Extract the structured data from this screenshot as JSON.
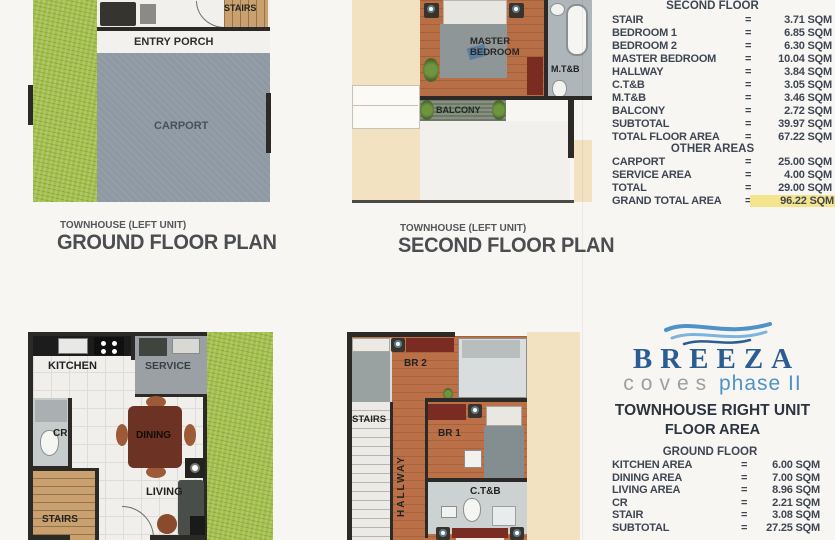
{
  "colors": {
    "grass": "#a4c04d",
    "carport_gray": "#8e99a4",
    "wood_floor": "#b96f45",
    "stair_wood": "#c9a06e",
    "beige": "#f3e2c2",
    "wall_black": "#2b2a27",
    "table_text": "#3f4653",
    "highlight_yellow": "#f5e48e",
    "logo_dark_blue": "#2b5d92",
    "logo_light_blue": "#4e92c8",
    "logo_gray": "#9aa0a5",
    "dark_red_furniture": "#7a2b22"
  },
  "plan_ground_left": {
    "caption_small": "TOWNHOUSE (LEFT UNIT)",
    "caption_large": "GROUND FLOOR PLAN",
    "labels": {
      "stairs": "STAIRS",
      "entry_porch": "ENTRY PORCH",
      "carport": "CARPORT"
    }
  },
  "plan_second_left": {
    "caption_small": "TOWNHOUSE (LEFT UNIT)",
    "caption_large": "SECOND FLOOR PLAN",
    "labels": {
      "master_bedroom": "MASTER BEDROOM",
      "mtb": "M.T&B",
      "balcony": "BALCONY"
    }
  },
  "plan_ground_right_unit": {
    "labels": {
      "kitchen": "KITCHEN",
      "service": "SERVICE",
      "cr": "CR",
      "dining": "DINING",
      "living": "LIVING",
      "stairs": "STAIRS"
    }
  },
  "plan_second_right_unit": {
    "labels": {
      "br2": "BR 2",
      "stairs": "STAIRS",
      "hallway": "HALLWAY",
      "br1": "BR 1",
      "ctb": "C.T&B"
    }
  },
  "second_floor_table": {
    "heading": "SECOND FLOOR",
    "rows": [
      {
        "name": "STAIR",
        "value": "3.71 SQM"
      },
      {
        "name": "BEDROOM 1",
        "value": "6.85 SQM"
      },
      {
        "name": "BEDROOM 2",
        "value": "6.30 SQM"
      },
      {
        "name": "MASTER BEDROOM",
        "value": "10.04 SQM"
      },
      {
        "name": "HALLWAY",
        "value": "3.84 SQM"
      },
      {
        "name": "C.T&B",
        "value": "3.05 SQM"
      },
      {
        "name": "M.T&B",
        "value": "3.46 SQM"
      },
      {
        "name": "BALCONY",
        "value": "2.72 SQM"
      },
      {
        "name": "SUBTOTAL",
        "value": "39.97 SQM"
      },
      {
        "name": "TOTAL FLOOR AREA",
        "value": "67.22 SQM"
      }
    ],
    "other_heading": "OTHER AREAS",
    "other_rows": [
      {
        "name": "CARPORT",
        "value": "25.00 SQM"
      },
      {
        "name": "SERVICE AREA",
        "value": "4.00 SQM"
      },
      {
        "name": "TOTAL",
        "value": "29.00 SQM"
      },
      {
        "name": "GRAND TOTAL AREA",
        "value": "96.22 SQM"
      }
    ]
  },
  "right_unit_block": {
    "brand": "BREEZA",
    "brand_sub_gray": "coves",
    "brand_sub_blue": "phase II",
    "title": "TOWNHOUSE RIGHT UNIT",
    "subtitle": "FLOOR AREA",
    "section_heading": "GROUND FLOOR",
    "rows": [
      {
        "name": "KITCHEN AREA",
        "value": "6.00 SQM"
      },
      {
        "name": "DINING AREA",
        "value": "7.00 SQM"
      },
      {
        "name": "LIVING AREA",
        "value": "8.96 SQM"
      },
      {
        "name": "CR",
        "value": "2.21 SQM"
      },
      {
        "name": "STAIR",
        "value": "3.08 SQM"
      },
      {
        "name": "SUBTOTAL",
        "value": "27.25 SQM"
      }
    ]
  },
  "misc": {
    "equals": "="
  }
}
